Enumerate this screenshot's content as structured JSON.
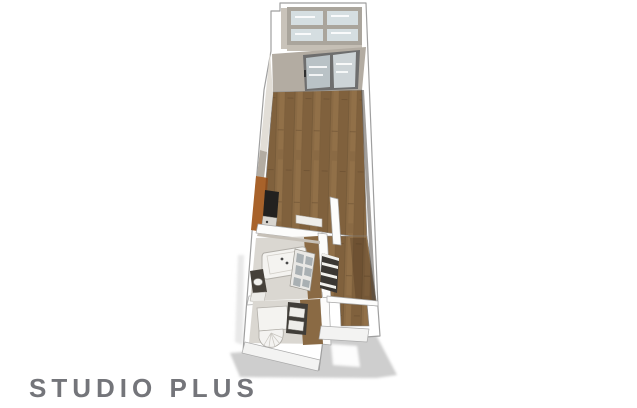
{
  "title": "STUDIO PLUS",
  "palette": {
    "text": "#74757a",
    "wall_white": "#ffffff",
    "wall_outline": "#9f9f9f",
    "wall_interior": "#b3aca2",
    "wall_interior_light": "#e2ded7",
    "wall_face_light": "#f3f3f2",
    "floor_wood": "#8a6a44",
    "floor_wood_dark": "#755836",
    "floor_wood_light": "#9b774d",
    "kitchen_counter": "#a8622a",
    "kitchen_counter_edge": "#8a4e20",
    "appliance_dark": "#23211f",
    "glass": "#d5dee1",
    "glass_pane_dark": "#b9c2c6",
    "glass_pane_light": "#cdd4d7",
    "glass_frame": "#aaa59c",
    "door_frame": "#6e6e6e",
    "fixture_white": "#f4f3f0",
    "fixture_outline": "#b2afa9",
    "tile_floor": "#dad7d1",
    "vanity_dark": "#46413a",
    "shelf_dark": "#3a3733",
    "shelf_face": "#eeede9",
    "rack_panel": "#a9b0b3",
    "shadow": "#cecece"
  },
  "floorplan": {
    "regions": [
      "balcony",
      "living-area",
      "kitchen",
      "bathroom",
      "toilet-room",
      "hallway",
      "entry"
    ]
  }
}
